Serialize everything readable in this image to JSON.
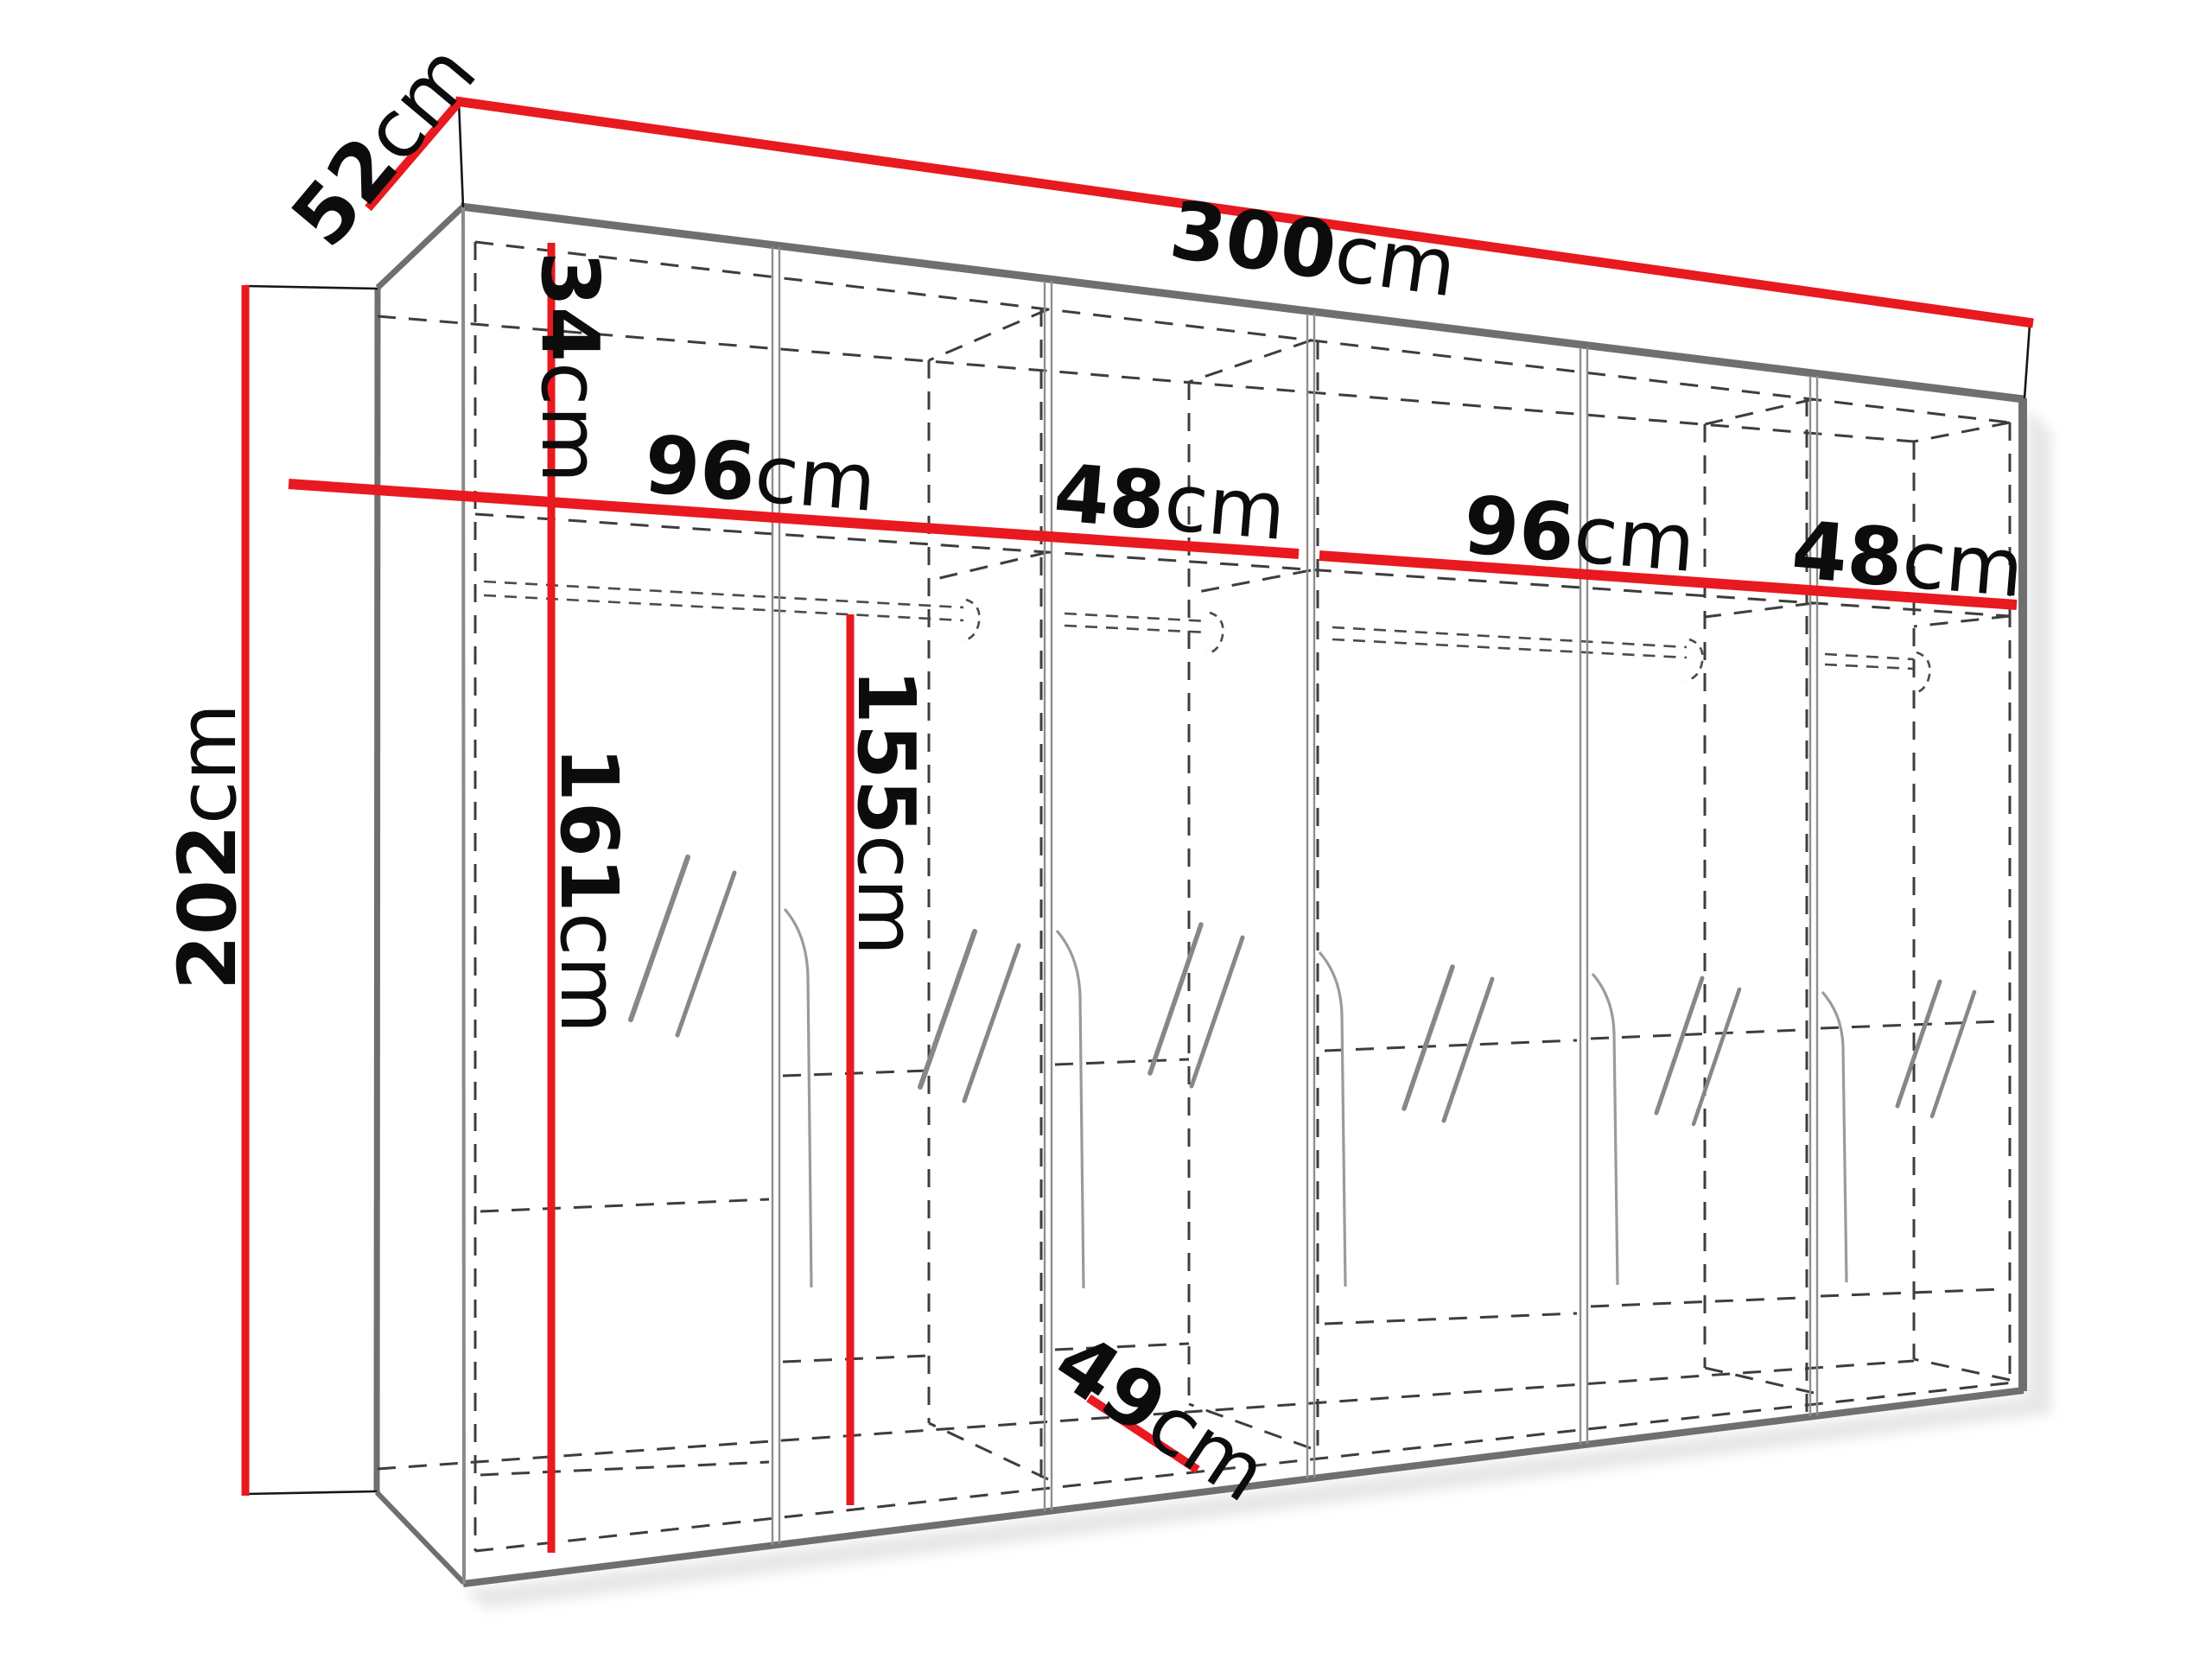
{
  "diagram": {
    "type": "furniture-dimension-drawing",
    "subject": "six-door wardrobe with mirrors, hanging rails and top shelf",
    "unit": "cm"
  },
  "colors": {
    "dimension": "#e8191f",
    "edge": "#6f6f6f",
    "door_gap": "#8f8f8f",
    "dashed": "#3d3d3d",
    "mirror": "#878787",
    "handle": "#9a9a9a",
    "extension": "#161616",
    "shadow": "#cfcfcf",
    "background": "#ffffff"
  },
  "dimensions": {
    "width": {
      "value": "300",
      "unit": "cm"
    },
    "depth": {
      "value": "52",
      "unit": "cm"
    },
    "height": {
      "value": "202",
      "unit": "cm"
    },
    "top_shelf_height": {
      "value": "34",
      "unit": "cm"
    },
    "left_wide_section": {
      "value": "96",
      "unit": "cm"
    },
    "left_narrow_section": {
      "value": "48",
      "unit": "cm"
    },
    "right_wide_section": {
      "value": "96",
      "unit": "cm"
    },
    "right_narrow_section": {
      "value": "48",
      "unit": "cm"
    },
    "left_hanging_space": {
      "value": "161",
      "unit": "cm"
    },
    "right_hanging_space": {
      "value": "155",
      "unit": "cm"
    },
    "interior_depth": {
      "value": "49",
      "unit": "cm"
    }
  }
}
